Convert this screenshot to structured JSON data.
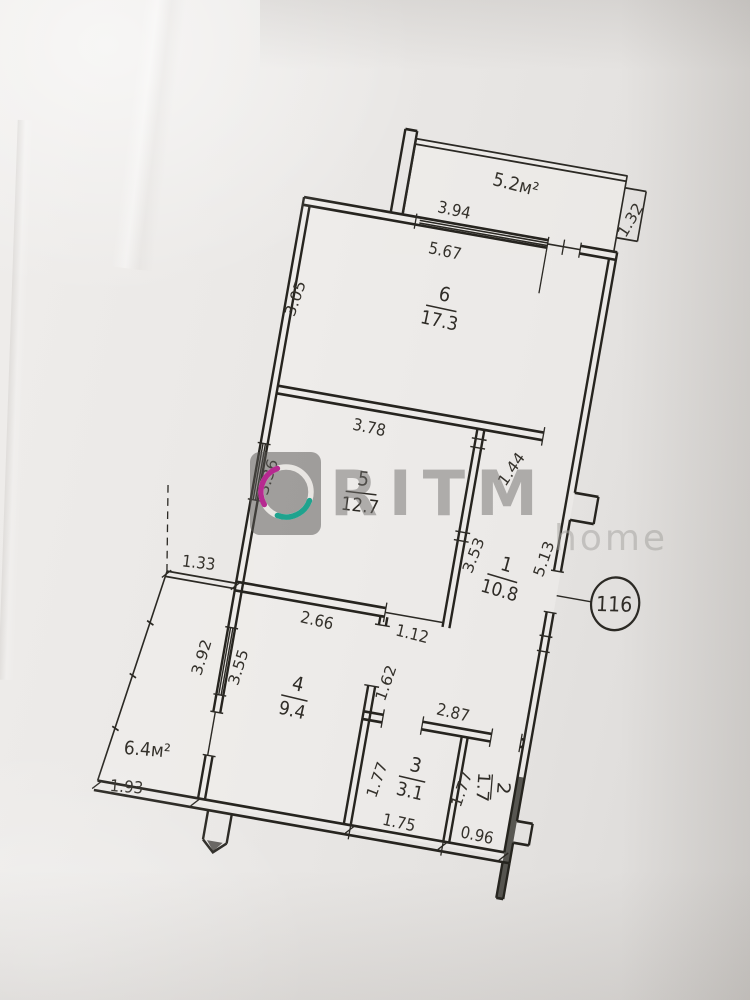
{
  "watermark": {
    "brand": "RITM",
    "word": "home"
  },
  "unit_badge": "116",
  "rooms": [
    {
      "number": "6",
      "area": "17.3"
    },
    {
      "number": "5",
      "area": "12.7"
    },
    {
      "number": "1",
      "area": "10.8"
    },
    {
      "number": "4",
      "area": "9.4"
    },
    {
      "number": "3",
      "area": "3.1"
    },
    {
      "number": "2",
      "area": "1.7"
    }
  ],
  "balconies": [
    {
      "label": "5.2м²"
    },
    {
      "label": "6.4м²"
    }
  ],
  "dims": {
    "balcony_top_window": "3.94",
    "balcony_top_depth": "1.32",
    "room6_width": "5.67",
    "room6_height": "3.05",
    "room5_width": "3.78",
    "hall_width_top": "1.44",
    "room5_height": "3.36",
    "room5_right": "3.53",
    "hall_right": "5.13",
    "room4_width": "2.66",
    "pass_width": "1.12",
    "hall_wall": "1.62",
    "balcony_left_length": "3.92",
    "room4_height": "3.55",
    "balcony_left_top": "1.33",
    "balcony_left_bottom": "1.93",
    "sanblock_width": "2.87",
    "room3_height": "1.77",
    "room3_width": "1.75",
    "room2_height": "1.77",
    "room2_width": "0.96"
  }
}
